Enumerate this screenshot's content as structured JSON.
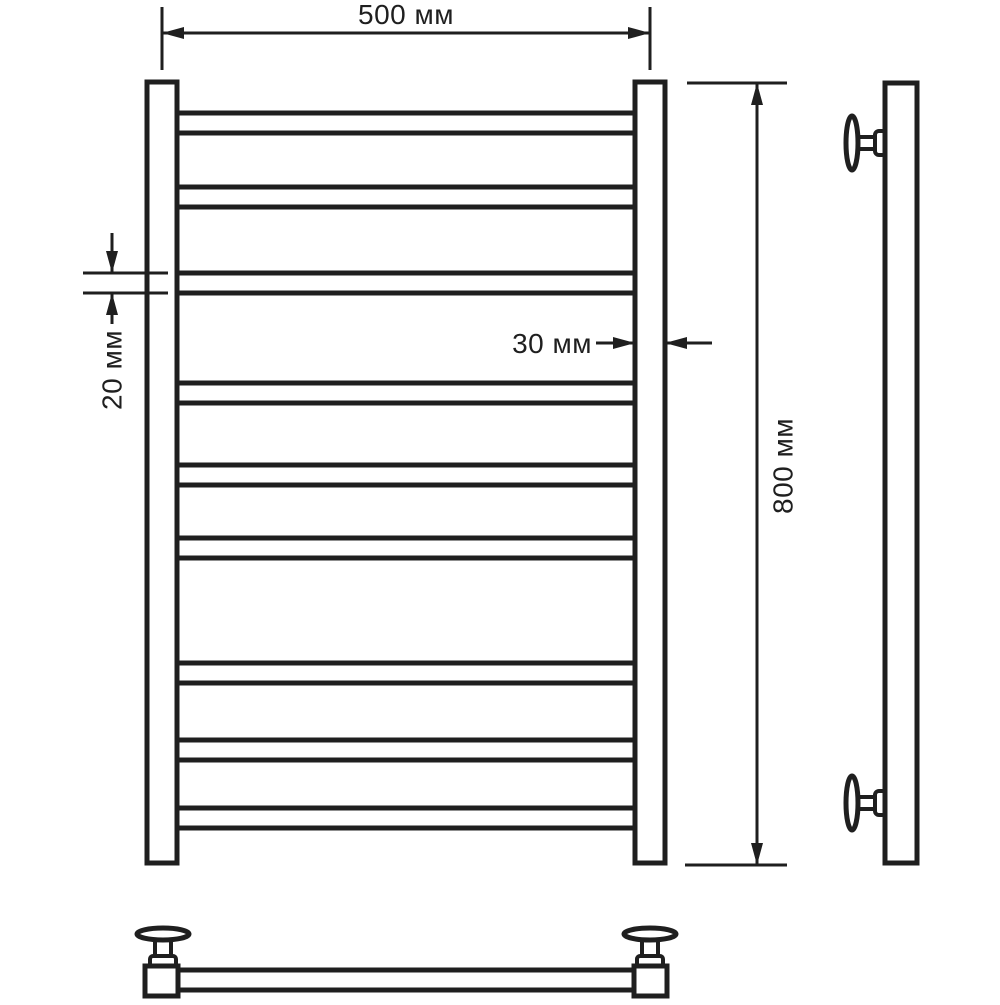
{
  "colors": {
    "line": "#1f1f1f",
    "background": "#ffffff"
  },
  "labels": {
    "width": "500 мм",
    "height": "800 мм",
    "rail_depth": "30 мм",
    "tube_diameter": "20 мм"
  },
  "front_view": {
    "rung_count": 9,
    "rung_x_start": 177,
    "rung_x_end": 635,
    "rungs_y": [
      [
        113,
        133
      ],
      [
        187,
        207
      ],
      [
        273,
        293
      ],
      [
        383,
        403
      ],
      [
        465,
        485
      ],
      [
        538,
        558
      ],
      [
        663,
        683
      ],
      [
        740,
        760
      ],
      [
        808,
        828
      ]
    ]
  }
}
